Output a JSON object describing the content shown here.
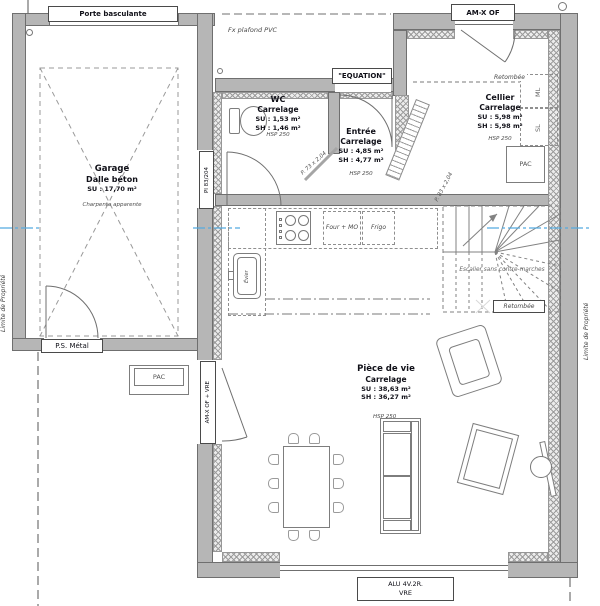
{
  "colors": {
    "wall": "#b6b6b6",
    "hatch_line": "#9c9c9c",
    "axis_blue": "#55abe0",
    "line": "#777777",
    "text": "#101018"
  },
  "labels": {
    "porte_basculante": "Porte basculante",
    "fx_plafond_pvc": "Fx plafond PVC",
    "equation": "\"EQUATION\"",
    "am_x_of": "AM-X OF",
    "pi_83_204": "PI 83/204",
    "p_73": "P. 73 x 2,04",
    "p_83": "P. 83 x 2,04",
    "retombee_cellier": "Retombée",
    "retombee_stairs": "Retombée",
    "ml": "ML",
    "sl": "SL",
    "pac_cellier": "PAC",
    "pac_exterior": "PAC",
    "ps_metal": "P.S. Métal",
    "am_x_of_vre": "AM-X OF + VRE",
    "alu_4v2r": "ALU 4V.2R.",
    "vre": "VRE",
    "limite_left": "Limite de Propriété",
    "limite_right": "Limite de Propriété",
    "escalier": "Escalier sans contre-marches",
    "four_mo": "Four + MO",
    "frigo": "Frigo",
    "evier": "Évier"
  },
  "rooms": {
    "garage": {
      "name": "Garage",
      "floor": "Dalle béton",
      "su": "SU : 17,70 m²",
      "note": "Charpente apparente"
    },
    "wc": {
      "name": "WC",
      "floor": "Carrelage",
      "su": "SU : 1,53 m²",
      "sh": "SH : 1,46 m²",
      "hsp": "HSP 250"
    },
    "entree": {
      "name": "Entrée",
      "floor": "Carrelage",
      "su": "SU : 4,85 m²",
      "sh": "SH : 4,77 m²",
      "hsp": "HSP 250"
    },
    "cellier": {
      "name": "Cellier",
      "floor": "Carrelage",
      "su": "SU : 5,98 m²",
      "sh": "SH : 5,98 m²",
      "hsp": "HSP 250"
    },
    "piece_de_vie": {
      "name": "Pièce de vie",
      "floor": "Carrelage",
      "su": "SU : 38,63 m²",
      "sh": "SH : 36,27 m²",
      "hsp": "HSP 250"
    }
  }
}
